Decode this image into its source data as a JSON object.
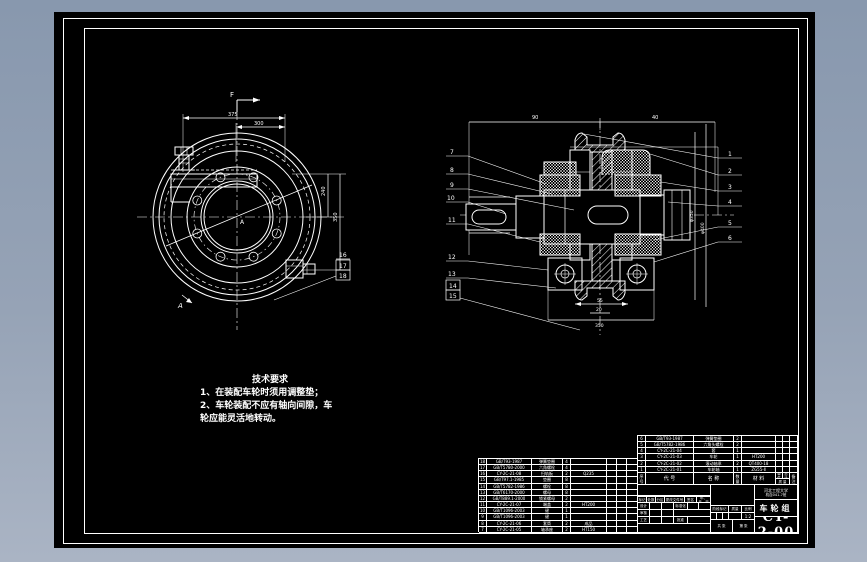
{
  "window": {
    "outer_bg": "#8e9bb0",
    "canvas_bg": "#000000",
    "line_color": "#ffffff"
  },
  "tech_req": {
    "title": "技术要求",
    "lines": [
      "1、在装配车轮时须用调整垫；",
      "2、车轮装配不应有轴向间隙，车",
      "轮应能灵活地转动。"
    ]
  },
  "view_labels": {
    "arrow_letter": "F",
    "section_letter": "A",
    "center_letter": "A"
  },
  "dims": {
    "front": {
      "top1": "375",
      "top2": "300",
      "right1": "240",
      "right2": "350"
    },
    "section": {
      "top1": "90",
      "top2": "40",
      "side1": "φ350",
      "side2": "φ400",
      "bot1": "55",
      "bot2": "20",
      "bolt_span": "350"
    }
  },
  "callouts": {
    "left": [
      "7",
      "8",
      "9",
      "10",
      "11",
      "12",
      "13"
    ],
    "left_boxed": [
      "14",
      "15"
    ],
    "right": [
      "1",
      "2",
      "3",
      "4",
      "5",
      "6"
    ],
    "front_top": "16",
    "front_boxed": [
      "17",
      "18"
    ]
  },
  "bom_header": {
    "seq": "序号",
    "code": "代 号",
    "name": "名 称",
    "qty": "数量",
    "material": "材 料",
    "w_single": "单件",
    "w_total": "总计",
    "w_label": "质 量",
    "notes": "备注"
  },
  "tables": {
    "bom_left": {
      "widths": [
        8,
        45,
        31,
        8,
        36,
        10,
        10,
        11
      ],
      "row_h": 6.17,
      "rows": [
        [
          "18",
          "GB/T93-1987",
          "弹簧垫圈",
          "4",
          "",
          "",
          "",
          ""
        ],
        [
          "17",
          "GB/T5780-2000",
          "六角螺栓",
          "4",
          "",
          "",
          "",
          ""
        ],
        [
          "16",
          "CY-2C-21-08",
          "扫轨板",
          "2",
          "Q235",
          "",
          "",
          ""
        ],
        [
          "15",
          "GB/T97.1-1985",
          "垫圈",
          "8",
          "",
          "",
          "",
          ""
        ],
        [
          "14",
          "GB/T5782-1986",
          "螺栓",
          "8",
          "",
          "",
          "",
          ""
        ],
        [
          "13",
          "GB/T6170-2000",
          "螺母",
          "8",
          "",
          "",
          "",
          ""
        ],
        [
          "12",
          "GB/T889.1-2000",
          "锁紧螺母",
          "2",
          "",
          "",
          "",
          ""
        ],
        [
          "11",
          "CY-2C-21-07",
          "端盖",
          "2",
          "HT200",
          "",
          "",
          ""
        ],
        [
          "10",
          "GB/T1096-2003",
          "键",
          "1",
          "",
          "",
          "",
          ""
        ],
        [
          "9",
          "GB/T1096-2003",
          "键",
          "1",
          "",
          "",
          "",
          ""
        ],
        [
          "8",
          "CY-2C-21-06",
          "套筒",
          "2",
          "成品",
          "",
          "",
          ""
        ],
        [
          "7",
          "CY-2C-21-05",
          "轴承座",
          "2",
          "HT150",
          "",
          "",
          ""
        ]
      ]
    },
    "bom_right": {
      "widths": [
        8,
        48,
        40,
        8,
        34,
        7,
        7,
        8
      ],
      "row_h": 6.17,
      "rows": [
        [
          "6",
          "GB/T93-1987",
          "弹簧垫圈",
          "2",
          "",
          "",
          "",
          ""
        ],
        [
          "5",
          "GB/T5782-1986",
          "六角头螺栓",
          "2",
          "",
          "",
          "",
          ""
        ],
        [
          "4",
          "CY-2C-21-04",
          "套",
          "1",
          "",
          "",
          "",
          ""
        ],
        [
          "3",
          "CY-2C-21-03",
          "车轮",
          "1",
          "HT200",
          "",
          "",
          ""
        ],
        [
          "2",
          "CY-2C-21-02",
          "滚动轴承",
          "2",
          "QT400-18",
          "",
          "",
          ""
        ],
        [
          "1",
          "CY-2C-21-01",
          "车轮轴",
          "1",
          "ZG55-Ⅱ",
          "",
          "",
          ""
        ]
      ]
    }
  },
  "titleblock": {
    "org_line1": "河北工程大学",
    "org_line2": "机自041-7班",
    "part_name": "车轮组",
    "drawing_no": "CY-2-00",
    "rev_labels": [
      "标记",
      "处数",
      "分区",
      "更改文件号",
      "签名",
      "年、月、日"
    ],
    "sig_design": "设计",
    "sig_check": "审核",
    "sig_process": "工艺",
    "sig_std": "标准化",
    "sig_approve": "批准",
    "stage_label": "阶段标记",
    "weight_label": "质量",
    "scale_label": "比例",
    "scale_value": "1:2",
    "sheet_total": "共 张",
    "sheet_no": "第 张"
  }
}
